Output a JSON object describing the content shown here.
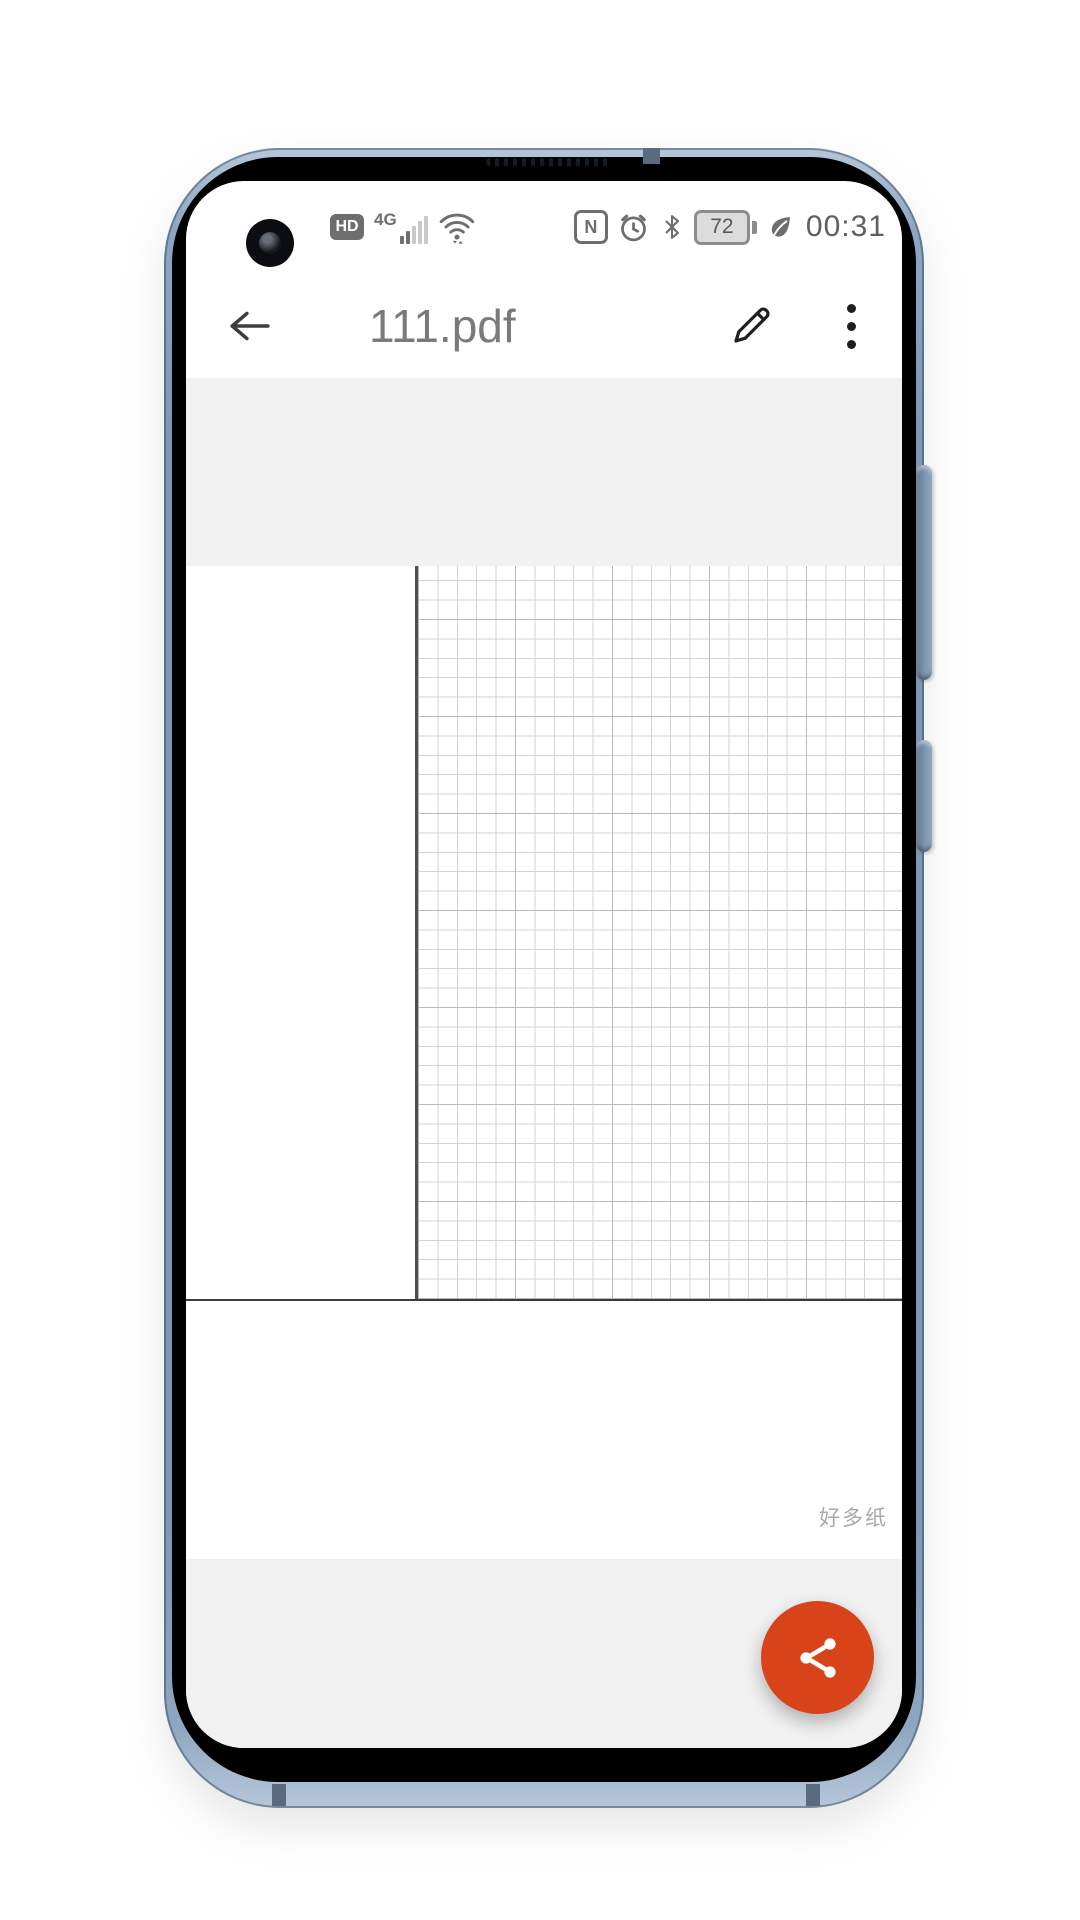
{
  "device": {
    "frame_color": "#7e97b2",
    "status_bar": {
      "hd_label": "HD",
      "network_label": "4G",
      "nfc_letter": "N",
      "battery_percent": "72",
      "time": "00:31"
    }
  },
  "app_bar": {
    "title": "111.pdf"
  },
  "document": {
    "page_style": "grid-paper",
    "watermark": "好多纸"
  },
  "fab": {
    "color": "#d8431a",
    "icon": "share-icon"
  }
}
